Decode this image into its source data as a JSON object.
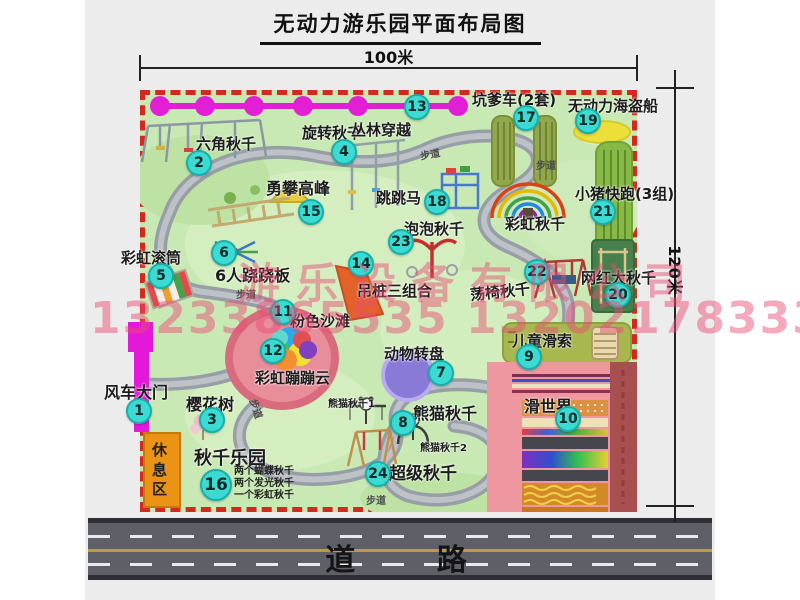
{
  "title": "无动力游乐园平面布局图",
  "dimensions": {
    "width_label": "100米",
    "height_label": "120米"
  },
  "road": {
    "label": "道 路"
  },
  "watermark": {
    "company": "游乐设备有限公司",
    "phones": "13233865535 13202178333"
  },
  "trail_label": "步道",
  "rest_area_label": "休息区",
  "extra_labels": {
    "rainbow_swing": "彩虹秋千",
    "panda1": "熊猫秋千1",
    "panda2": "熊猫秋千2"
  },
  "attractions": [
    {
      "num": "1",
      "name": "风车大门"
    },
    {
      "num": "2",
      "name": "六角秋千"
    },
    {
      "num": "3",
      "name": "樱花树"
    },
    {
      "num": "4",
      "name": "旋转秋千"
    },
    {
      "num": "5",
      "name": "彩虹滚筒"
    },
    {
      "num": "6",
      "name": "6人跷跷板"
    },
    {
      "num": "7",
      "name": "动物转盘"
    },
    {
      "num": "8",
      "name": "熊猫秋千"
    },
    {
      "num": "9",
      "name": "儿童滑索"
    },
    {
      "num": "10",
      "name": "滑世界"
    },
    {
      "num": "11",
      "name": "粉色沙滩"
    },
    {
      "num": "12",
      "name": "彩虹蹦蹦云"
    },
    {
      "num": "13",
      "name": "丛林穿越"
    },
    {
      "num": "14",
      "name": "吊桩三组合"
    },
    {
      "num": "15",
      "name": "勇攀高峰"
    },
    {
      "num": "16",
      "name": "秋千乐园",
      "details": [
        "两个蝴蝶秋千",
        "两个发光秋千",
        "一个彩虹秋千"
      ]
    },
    {
      "num": "17",
      "name": "坑爹车(2套)"
    },
    {
      "num": "18",
      "name": "跳跳马"
    },
    {
      "num": "19",
      "name": "无动力海盗船"
    },
    {
      "num": "20",
      "name": "网红大秋千"
    },
    {
      "num": "21",
      "name": "小猪快跑(3组)"
    },
    {
      "num": "22",
      "name": "荡椅秋千"
    },
    {
      "num": "23",
      "name": "泡泡秋千"
    },
    {
      "num": "24",
      "name": "超级秋千"
    }
  ],
  "colors": {
    "map_green": "#c8e8b4",
    "border_red": "#d42a1e",
    "badge_cyan": "#3bdad2",
    "zipline_magenta": "#e21fd4",
    "gate_magenta": "#e318d8",
    "rest_orange": "#ea9315",
    "road_gray": "#5f5f67",
    "watermark_pink": "#ea4c76"
  }
}
